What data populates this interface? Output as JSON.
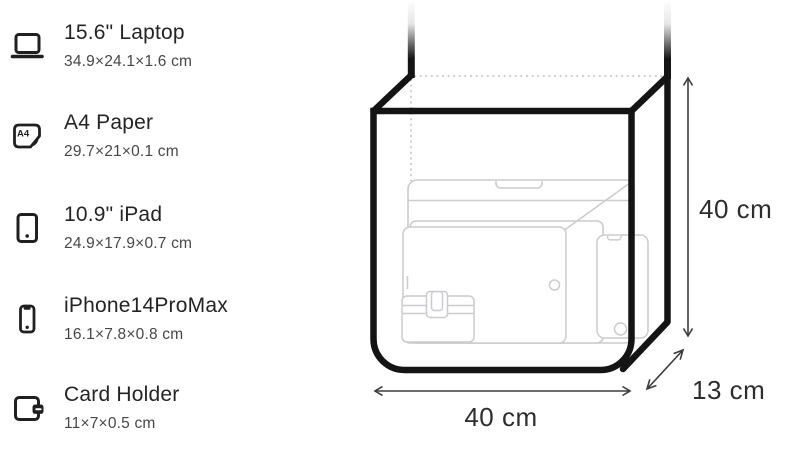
{
  "items": [
    {
      "title": "15.6\" Laptop",
      "dims": "34.9×24.1×1.6 cm",
      "icon": "laptop-icon"
    },
    {
      "title": "A4 Paper",
      "dims": "29.7×21×0.1 cm",
      "icon": "a4-paper-icon"
    },
    {
      "title": "10.9\" iPad",
      "dims": "24.9×17.9×0.7 cm",
      "icon": "tablet-icon"
    },
    {
      "title": "iPhone14ProMax",
      "dims": "16.1×7.8×0.8 cm",
      "icon": "phone-icon"
    },
    {
      "title": "Card Holder",
      "dims": "11×7×0.5 cm",
      "icon": "card-holder-icon"
    }
  ],
  "bag": {
    "height_label": "40 cm",
    "width_label": "40 cm",
    "depth_label": "13 cm",
    "ghost": {
      "a4_label": "A4",
      "laptop_diagonal_label": "15.6"
    }
  },
  "icons": {
    "a4_text": "A4"
  },
  "colors": {
    "ink": "#141414",
    "title_text": "#242427",
    "dims_text": "#47474b",
    "ghost_line": "#c9ccd0",
    "ghost_text": "#d2d5d8",
    "dimension_line": "#3c3c3c"
  }
}
